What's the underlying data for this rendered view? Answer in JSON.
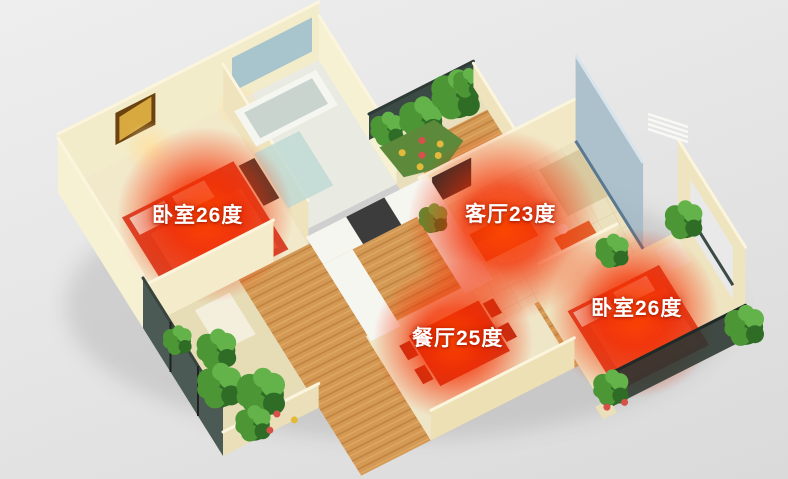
{
  "colors": {
    "background": "#e5e5e5",
    "wall_cream": "#f3ecca",
    "wall_light": "#f7f1d4",
    "wall_mid": "#eee0b5",
    "wall_shadow": "#d9c692",
    "wall_top": "#fbf5dd",
    "floor_wood": "#d49a55",
    "wood_stripe_dark": "#c08440",
    "wood_stripe_light": "#e0ac66",
    "floor_tile": "#ece1bf",
    "tile_line": "#ddcfa4",
    "floor_warm": "#f2e8ca",
    "bath_floor": "#e9ebe2",
    "glass_blue": "#9db8c4",
    "window_dark": "#4b5a55",
    "railing_dark": "#3c4a46",
    "plant_green": "#4c9636",
    "plant_dark": "#2f6d26",
    "plant_light": "#63b34a",
    "flower_yellow": "#e4b93a",
    "flower_red": "#d8504a",
    "heat_red": "#f52d00",
    "heat_core": "#ff4800",
    "bed_red": "#d6452c",
    "blanket_red": "#e2573a",
    "pillow_white": "#efe8df",
    "sofa_orange": "#e0662f",
    "sofa_tan": "#d9c9a0",
    "counter_white": "#f6f6f1",
    "appliance_dark": "#3c3c3c",
    "tv_dark": "#2b2b2b",
    "frame_gold": "#d8a93f",
    "frame_brown": "#6b4310",
    "label_text": "#ffffff"
  },
  "labels": {
    "bedroom_left": "卧室26度",
    "living_room": "客厅23度",
    "dining_room": "餐厅25度",
    "bedroom_right": "卧室26度"
  }
}
